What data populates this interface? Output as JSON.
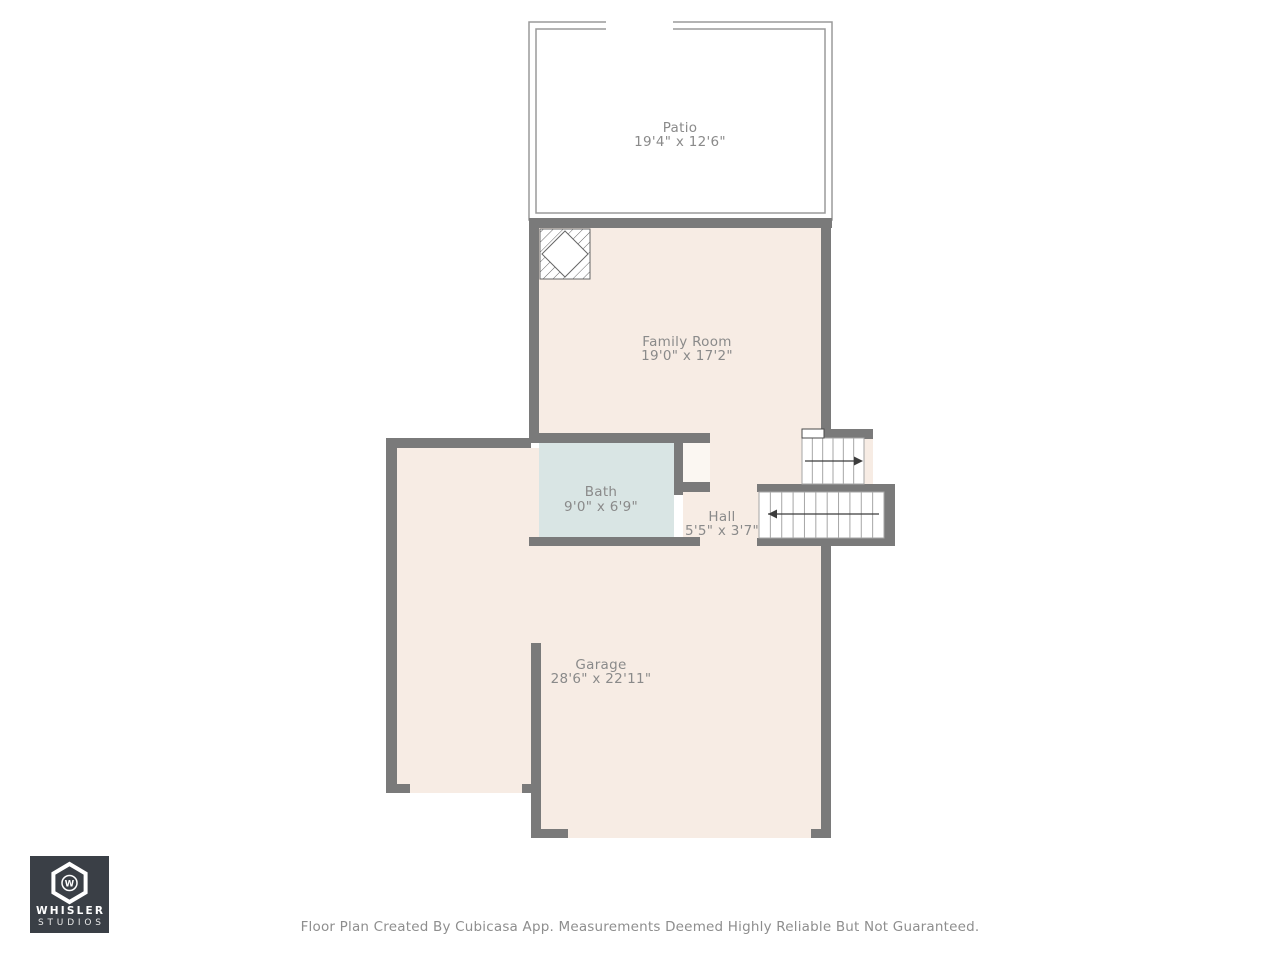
{
  "colors": {
    "wall": "#7a7a7a",
    "floor": "#f7ece4",
    "patio": "#ededee",
    "bath": "#d9e5e4",
    "nook": "#fbf7f2",
    "outline": "#9a9a9a",
    "stair_line": "#a6a6a6",
    "arrow": "#3c3c3c",
    "label": "#8a8a8a",
    "fixture": "#666666",
    "footer": "#8e8e8e",
    "logo_bg": "#3a3f46"
  },
  "rooms": {
    "patio": {
      "label": "Patio",
      "dims": "19'4\" x 12'6\""
    },
    "family_room": {
      "label": "Family Room",
      "dims": "19'0\" x 17'2\""
    },
    "bath": {
      "label": "Bath",
      "dims": "9'0\" x 6'9\""
    },
    "hall": {
      "label": "Hall",
      "dims": "5'5\" x 3'7\""
    },
    "garage": {
      "label": "Garage",
      "dims": "28'6\" x 22'11\""
    }
  },
  "stairs": {
    "up": {
      "steps": 6,
      "direction": "right"
    },
    "down": {
      "steps": 11,
      "direction": "left"
    }
  },
  "logo": {
    "monogram": "W",
    "brand_line1": "WHISLER",
    "brand_line2": "STUDIOS"
  },
  "footer": {
    "disclaimer": "Floor Plan Created By Cubicasa App. Measurements Deemed Highly Reliable But Not Guaranteed."
  }
}
